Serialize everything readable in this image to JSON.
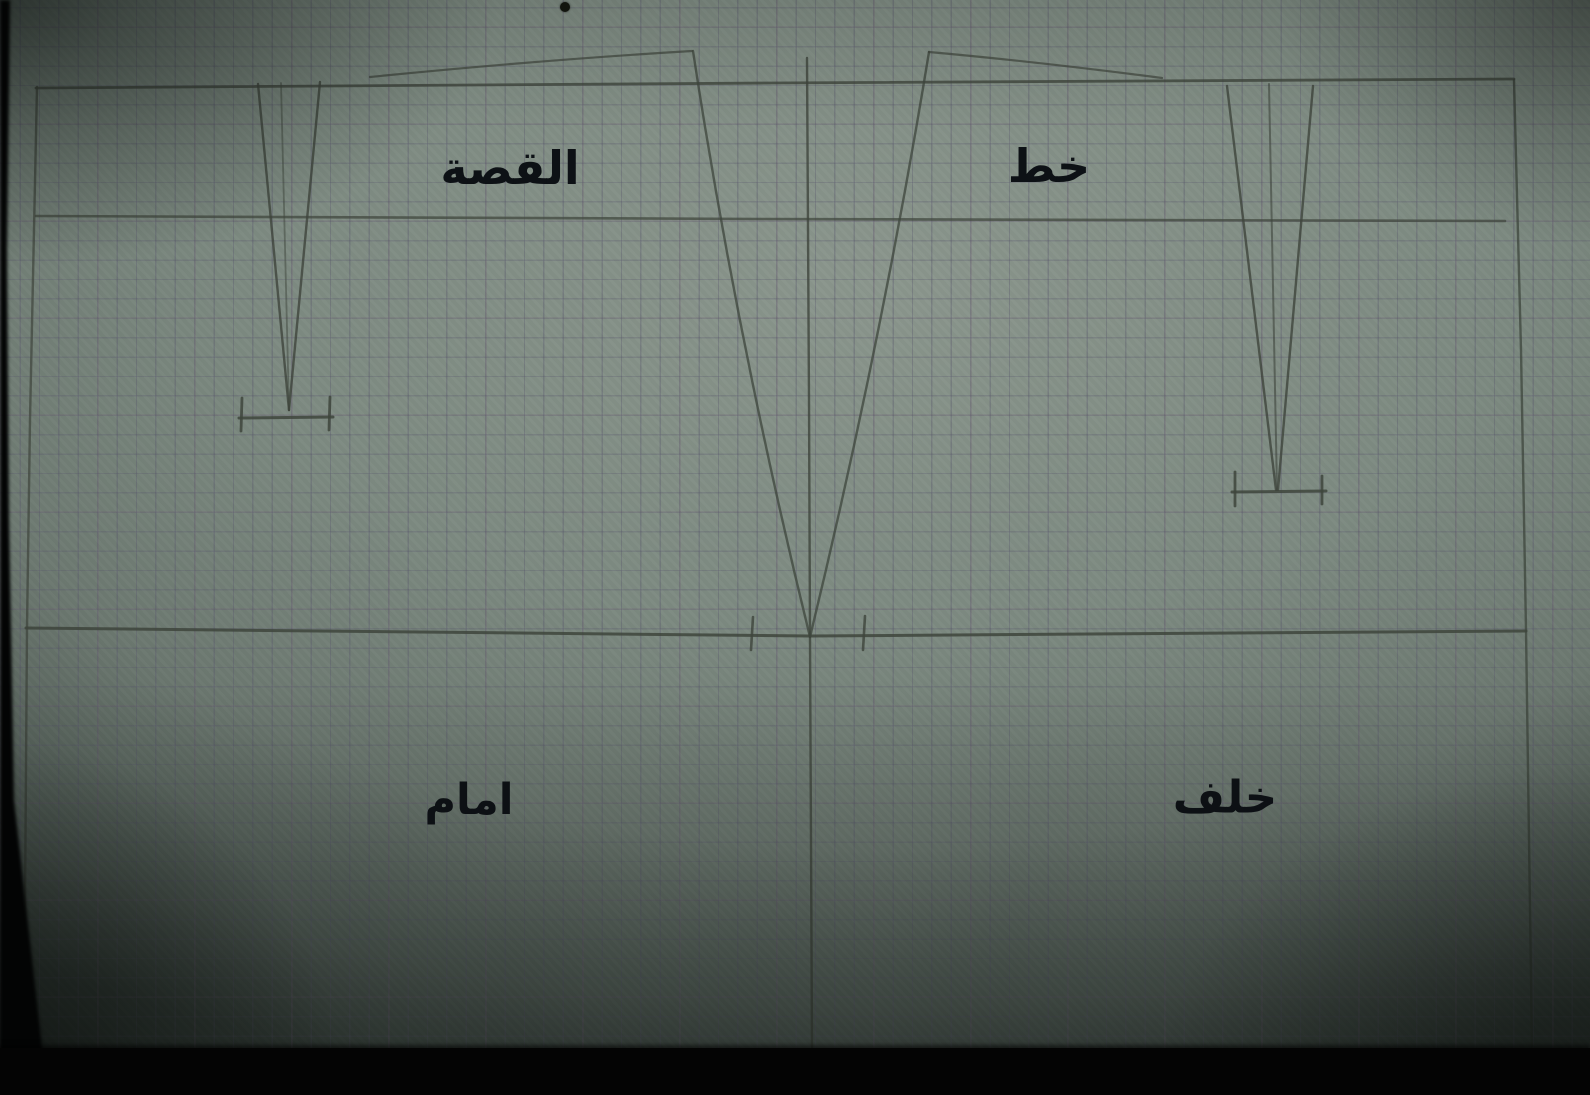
{
  "figure_title": "skirt block pattern draft photographed on graph paper",
  "colors": {
    "pencil": "#3e453c",
    "label_ink": "#0d1115",
    "black_bar": "#040404"
  },
  "labels": [
    {
      "id": "yoke",
      "text": "القصة",
      "x": 510,
      "y": 168,
      "size": 46
    },
    {
      "id": "line",
      "text": "خط",
      "x": 1049,
      "y": 166,
      "size": 46
    },
    {
      "id": "front",
      "text": "امام",
      "x": 469,
      "y": 800,
      "size": 43
    },
    {
      "id": "back",
      "text": "خلف",
      "x": 1225,
      "y": 797,
      "size": 45
    }
  ],
  "strokes": [
    {
      "name": "waist-construction-line",
      "d": "M 36 88 L 770 83 L 1514 79",
      "w": 2.8,
      "o": 0.8
    },
    {
      "name": "yoke-line",
      "d": "M 36 216 L 760 219 L 1505 221",
      "w": 2.6,
      "o": 0.72
    },
    {
      "name": "hip-line",
      "d": "M 26 628 L 810 636 L 1526 631",
      "w": 3.0,
      "o": 0.85
    },
    {
      "name": "center-front-edge",
      "d": "M 37 87 L 30 420 L 27 628 L 24 1047",
      "w": 2.4,
      "o": 0.7
    },
    {
      "name": "center-back-edge",
      "d": "M 1514 80 L 1521 350 L 1526 630 L 1532 1047",
      "w": 2.4,
      "o": 0.75
    },
    {
      "name": "side-seam-vertical",
      "d": "M 807 58 L 809 400 L 810 637 L 812 1047",
      "w": 2.4,
      "o": 0.8
    },
    {
      "name": "front-waist-raise-curve",
      "d": "M 370 77 Q 540 60 692 51",
      "w": 2.2,
      "o": 0.7
    },
    {
      "name": "front-side-seam",
      "d": "M 693 51 Q 737 340 810 637",
      "w": 2.4,
      "o": 0.75
    },
    {
      "name": "back-side-seam",
      "d": "M 929 52 Q 882 340 810 637",
      "w": 2.4,
      "o": 0.75
    },
    {
      "name": "back-waist-raise-curve",
      "d": "M 929 52 Q 1040 62 1162 78",
      "w": 2.2,
      "o": 0.7
    },
    {
      "name": "front-dart-left-leg",
      "d": "M 258 84 L 289 410",
      "w": 2.4,
      "o": 0.8
    },
    {
      "name": "front-dart-center-line",
      "d": "M 281 83 L 289 410",
      "w": 1.8,
      "o": 0.5
    },
    {
      "name": "front-dart-right-leg",
      "d": "M 320 82 L 289 410",
      "w": 2.4,
      "o": 0.8
    },
    {
      "name": "front-dart-bar",
      "d": "M 239 418 L 333 417",
      "w": 3.0,
      "o": 0.85
    },
    {
      "name": "front-dart-bar-tick-left",
      "d": "M 242 398 L 241 431",
      "w": 2.8,
      "o": 0.85
    },
    {
      "name": "front-dart-bar-tick-right",
      "d": "M 330 397 L 329 430",
      "w": 2.8,
      "o": 0.85
    },
    {
      "name": "back-dart-left-leg",
      "d": "M 1227 86 L 1276 490",
      "w": 2.4,
      "o": 0.8
    },
    {
      "name": "back-dart-center-line",
      "d": "M 1269 84 L 1277 490",
      "w": 2.0,
      "o": 0.6
    },
    {
      "name": "back-dart-right-leg",
      "d": "M 1313 86 L 1278 490",
      "w": 2.4,
      "o": 0.8
    },
    {
      "name": "back-dart-bar",
      "d": "M 1232 492 L 1326 491",
      "w": 3.0,
      "o": 0.85
    },
    {
      "name": "back-dart-bar-tick-left",
      "d": "M 1235 472 L 1235 506",
      "w": 2.8,
      "o": 0.85
    },
    {
      "name": "back-dart-bar-tick-right",
      "d": "M 1322 476 L 1322 504",
      "w": 2.8,
      "o": 0.85
    },
    {
      "name": "hip-notch-left",
      "d": "M 753 617 L 751 650",
      "w": 2.6,
      "o": 0.8
    },
    {
      "name": "hip-notch-right",
      "d": "M 865 616 L 863 650",
      "w": 2.6,
      "o": 0.8
    }
  ],
  "marks": {
    "ink_dot": {
      "x": 565,
      "y": 7,
      "r": 5
    }
  },
  "left_black_edge_polygon": "M0,0 L10,0 L7,250 L9,520 L14,800 L42,1048 L60,1095 L0,1095 Z"
}
